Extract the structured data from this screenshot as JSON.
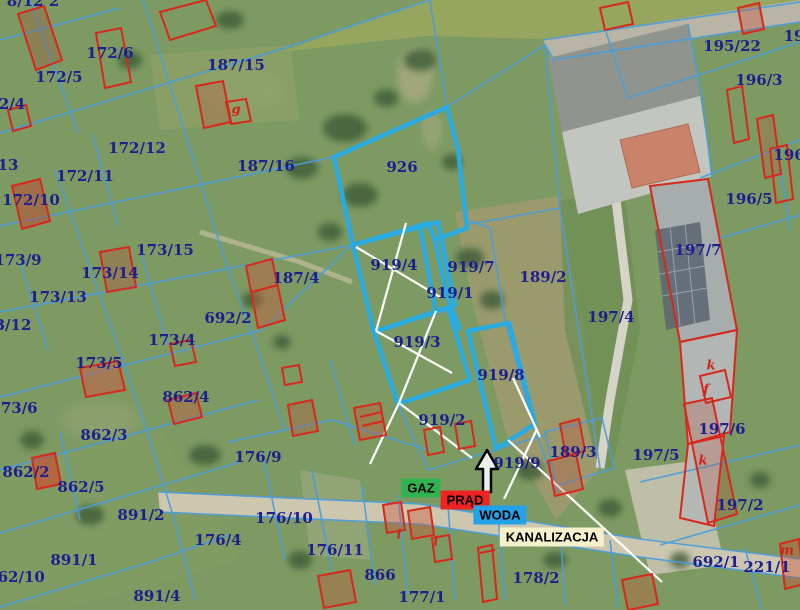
{
  "map": {
    "type": "cadastral-parcel-overlay-on-aerial-photo",
    "label_color": "#1e1e8f",
    "boundary_color": "#4b9ddb",
    "highlight_color": "#29abe2",
    "building_outline_color": "#d7281b",
    "marker_line_color": "#ffffff"
  },
  "parcels": [
    {
      "id": "8/12 2",
      "x": 33,
      "y": 1
    },
    {
      "id": "172/6",
      "x": 110,
      "y": 53
    },
    {
      "id": "172/5",
      "x": 59,
      "y": 77
    },
    {
      "id": "2/4",
      "x": 12,
      "y": 104
    },
    {
      "id": "187/15",
      "x": 236,
      "y": 65
    },
    {
      "id": "172/12",
      "x": 137,
      "y": 148
    },
    {
      "id": "172/11",
      "x": 85,
      "y": 176
    },
    {
      "id": "13",
      "x": 8,
      "y": 165
    },
    {
      "id": "172/10",
      "x": 31,
      "y": 200
    },
    {
      "id": "187/16",
      "x": 266,
      "y": 166
    },
    {
      "id": "173/9",
      "x": 18,
      "y": 260
    },
    {
      "id": "173/15",
      "x": 165,
      "y": 250
    },
    {
      "id": "173/14",
      "x": 110,
      "y": 273
    },
    {
      "id": "173/13",
      "x": 58,
      "y": 297
    },
    {
      "id": "3/12",
      "x": 13,
      "y": 325
    },
    {
      "id": "692/2",
      "x": 228,
      "y": 318
    },
    {
      "id": "187/4",
      "x": 296,
      "y": 278
    },
    {
      "id": "173/4",
      "x": 172,
      "y": 340
    },
    {
      "id": "173/5",
      "x": 99,
      "y": 363
    },
    {
      "id": "173/6",
      "x": 14,
      "y": 408
    },
    {
      "id": "862/4",
      "x": 186,
      "y": 397
    },
    {
      "id": "862/3",
      "x": 104,
      "y": 435
    },
    {
      "id": "862/2",
      "x": 26,
      "y": 472
    },
    {
      "id": "862/5",
      "x": 81,
      "y": 487
    },
    {
      "id": "891/2",
      "x": 141,
      "y": 515
    },
    {
      "id": "891/1",
      "x": 74,
      "y": 560
    },
    {
      "id": "862/10",
      "x": 16,
      "y": 577
    },
    {
      "id": "891/4",
      "x": 157,
      "y": 596
    },
    {
      "id": "176/4",
      "x": 218,
      "y": 540
    },
    {
      "id": "176/9",
      "x": 258,
      "y": 457
    },
    {
      "id": "176/10",
      "x": 284,
      "y": 518
    },
    {
      "id": "176/11",
      "x": 335,
      "y": 550
    },
    {
      "id": "866",
      "x": 380,
      "y": 575
    },
    {
      "id": "177/1",
      "x": 422,
      "y": 597
    },
    {
      "id": "178/2",
      "x": 536,
      "y": 578
    },
    {
      "id": "926",
      "x": 402,
      "y": 167
    },
    {
      "id": "919/4",
      "x": 394,
      "y": 265
    },
    {
      "id": "919/7",
      "x": 471,
      "y": 267
    },
    {
      "id": "919/1",
      "x": 450,
      "y": 293
    },
    {
      "id": "189/2",
      "x": 543,
      "y": 277
    },
    {
      "id": "919/3",
      "x": 417,
      "y": 342
    },
    {
      "id": "919/8",
      "x": 501,
      "y": 375
    },
    {
      "id": "919/2",
      "x": 442,
      "y": 420
    },
    {
      "id": "919/9",
      "x": 517,
      "y": 463
    },
    {
      "id": "189/3",
      "x": 573,
      "y": 452
    },
    {
      "id": "197/4",
      "x": 611,
      "y": 317
    },
    {
      "id": "197/5",
      "x": 656,
      "y": 455
    },
    {
      "id": "197/7",
      "x": 698,
      "y": 250
    },
    {
      "id": "197/6",
      "x": 722,
      "y": 429
    },
    {
      "id": "197/2",
      "x": 740,
      "y": 505
    },
    {
      "id": "692/1",
      "x": 716,
      "y": 562
    },
    {
      "id": "221/1",
      "x": 767,
      "y": 567
    },
    {
      "id": "195/22",
      "x": 732,
      "y": 46
    },
    {
      "id": "196/3",
      "x": 759,
      "y": 80
    },
    {
      "id": "196/1",
      "x": 797,
      "y": 155
    },
    {
      "id": "196/5",
      "x": 749,
      "y": 199
    },
    {
      "id": "19",
      "x": 794,
      "y": 36
    }
  ],
  "building_letters": [
    {
      "ch": "g",
      "x": 236,
      "y": 110
    },
    {
      "ch": "k",
      "x": 711,
      "y": 366
    },
    {
      "ch": "f",
      "x": 706,
      "y": 390
    },
    {
      "ch": "k",
      "x": 703,
      "y": 461
    },
    {
      "ch": "m",
      "x": 787,
      "y": 551
    },
    {
      "ch": "i",
      "x": 399,
      "y": 535
    },
    {
      "ch": "i",
      "x": 436,
      "y": 542
    }
  ],
  "utilities": [
    {
      "label": "GAZ",
      "bg": "#2eb34e",
      "x": 421,
      "y": 488
    },
    {
      "label": "PRĄD",
      "bg": "#ee2424",
      "x": 465,
      "y": 500
    },
    {
      "label": "WODA",
      "bg": "#23a2e8",
      "x": 500,
      "y": 515
    },
    {
      "label": "KANALIZACJA",
      "bg": "#f7f0cc",
      "x": 552,
      "y": 537
    }
  ]
}
